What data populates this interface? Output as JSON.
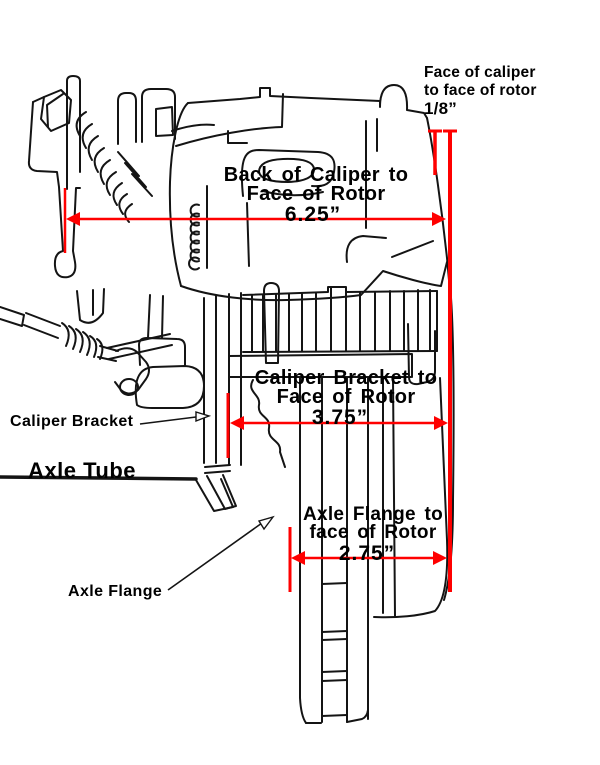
{
  "figure": {
    "type": "technical-diagram",
    "subject": "Brake caliper, caliper bracket, rotor and axle measurement diagram",
    "colors": {
      "dimension_red": "#ff0000",
      "line_black": "#141414",
      "background": "#ffffff",
      "text": "#000000"
    },
    "part_labels": [
      {
        "name": "caliper-bracket",
        "text": "Caliper Bracket"
      },
      {
        "name": "axle-tube",
        "text": "Axle Tube"
      },
      {
        "name": "axle-flange",
        "text": "Axle Flange"
      }
    ],
    "dimensions": [
      {
        "name": "face-of-caliper-to-face-of-rotor",
        "line1": "Face of caliper",
        "line2": "to face of rotor",
        "value": "1/8”"
      },
      {
        "name": "back-of-caliper-to-face-of-rotor",
        "line1": "Back of Caliper to",
        "line2": "Face of Rotor",
        "value": "6.25”"
      },
      {
        "name": "caliper-bracket-to-face-of-rotor",
        "line1": "Caliper Bracket to",
        "line2": "Face of Rotor",
        "value": "3.75”"
      },
      {
        "name": "axle-flange-to-face-of-rotor",
        "line1": "Axle Flange to",
        "line2": "face of Rotor",
        "value": "2.75”"
      }
    ]
  }
}
